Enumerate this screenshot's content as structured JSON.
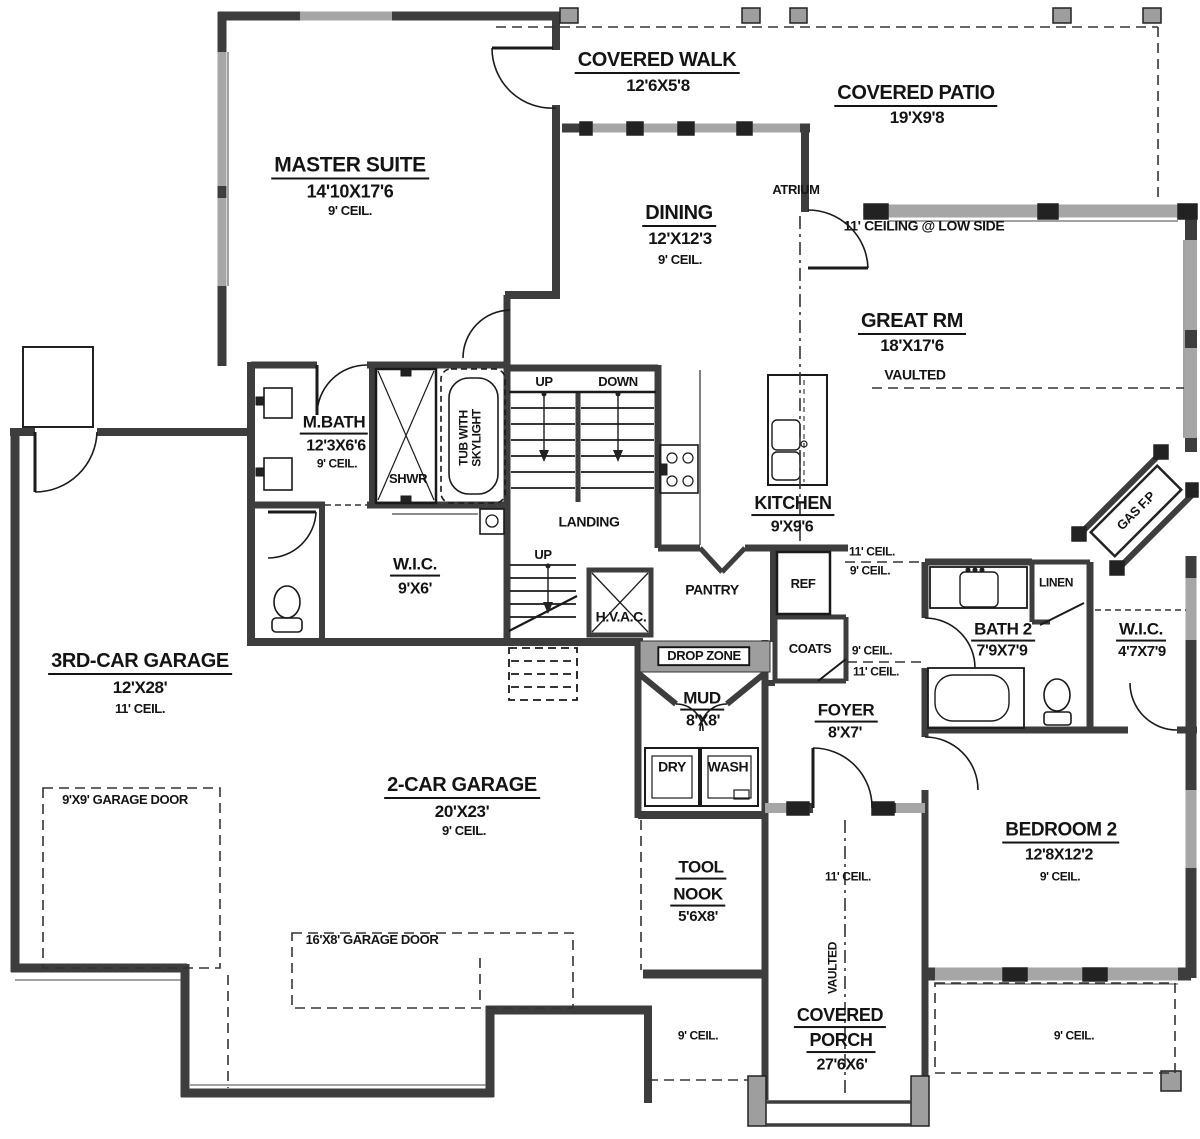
{
  "rooms": {
    "master_suite": {
      "name": "MASTER SUITE",
      "dims": "14'10X17'6",
      "ceil": "9' CEIL."
    },
    "covered_walk": {
      "name": "COVERED WALK",
      "dims": "12'6X5'8"
    },
    "covered_patio": {
      "name": "COVERED PATIO",
      "dims": "19'X9'8"
    },
    "dining": {
      "name": "DINING",
      "dims": "12'X12'3",
      "ceil": "9' CEIL."
    },
    "great_rm": {
      "name": "GREAT RM",
      "dims": "18'X17'6",
      "ceil": "VAULTED"
    },
    "m_bath": {
      "name": "M.BATH",
      "dims": "12'3X6'6",
      "ceil": "9' CEIL."
    },
    "wic_master": {
      "name": "W.I.C.",
      "dims": "9'X6'"
    },
    "kitchen": {
      "name": "KITCHEN",
      "dims": "9'X9'6"
    },
    "bath2": {
      "name": "BATH 2",
      "dims": "7'9X7'9"
    },
    "wic2": {
      "name": "W.I.C.",
      "dims": "4'7X7'9"
    },
    "garage3": {
      "name": "3RD-CAR GARAGE",
      "dims": "12'X28'",
      "ceil": "11' CEIL."
    },
    "garage2": {
      "name": "2-CAR GARAGE",
      "dims": "20'X23'",
      "ceil": "9' CEIL."
    },
    "mud": {
      "name": "MUD",
      "dims": "8'X8'"
    },
    "foyer": {
      "name": "FOYER",
      "dims": "8'X7'"
    },
    "tool_nook": {
      "name1": "TOOL",
      "name2": "NOOK",
      "dims": "5'6X8'"
    },
    "covered_porch": {
      "name1": "COVERED",
      "name2": "PORCH",
      "dims": "27'6X6'"
    },
    "bedroom2": {
      "name": "BEDROOM 2",
      "dims": "12'8X12'2",
      "ceil": "9' CEIL."
    }
  },
  "features": {
    "atrium": "ATRIUM",
    "ceiling_low_side": "11' CEILING @ LOW SIDE",
    "up": "UP",
    "down": "DOWN",
    "landing": "LANDING",
    "up2": "UP",
    "hvac": "H.V.A.C.",
    "shwr": "SHWR",
    "tub_line1": "TUB WITH",
    "tub_line2": "SKYLIGHT",
    "pantry": "PANTRY",
    "ref": "REF",
    "coats": "COATS",
    "drop_zone": "DROP ZONE",
    "dry": "DRY",
    "wash": "WASH",
    "linen": "LINEN",
    "gas_fp": "GAS F.P",
    "garage_door_9": "9'X9' GARAGE DOOR",
    "garage_door_16": "16'X8' GARAGE DOOR",
    "vaulted_porch": "VAULTED",
    "ceil_11a": "11' CEIL.",
    "ceil_9a": "9' CEIL.",
    "ceil_9b": "9' CEIL.",
    "ceil_11b": "11' CEIL.",
    "ceil_11_hall": "11' CEIL.",
    "ceil_9_left": "9' CEIL.",
    "ceil_9_right": "9' CEIL."
  },
  "colors": {
    "wall": "#3d3d3d",
    "window": "#a6a6a6",
    "line": "#1a1a1a",
    "background": "#ffffff"
  }
}
